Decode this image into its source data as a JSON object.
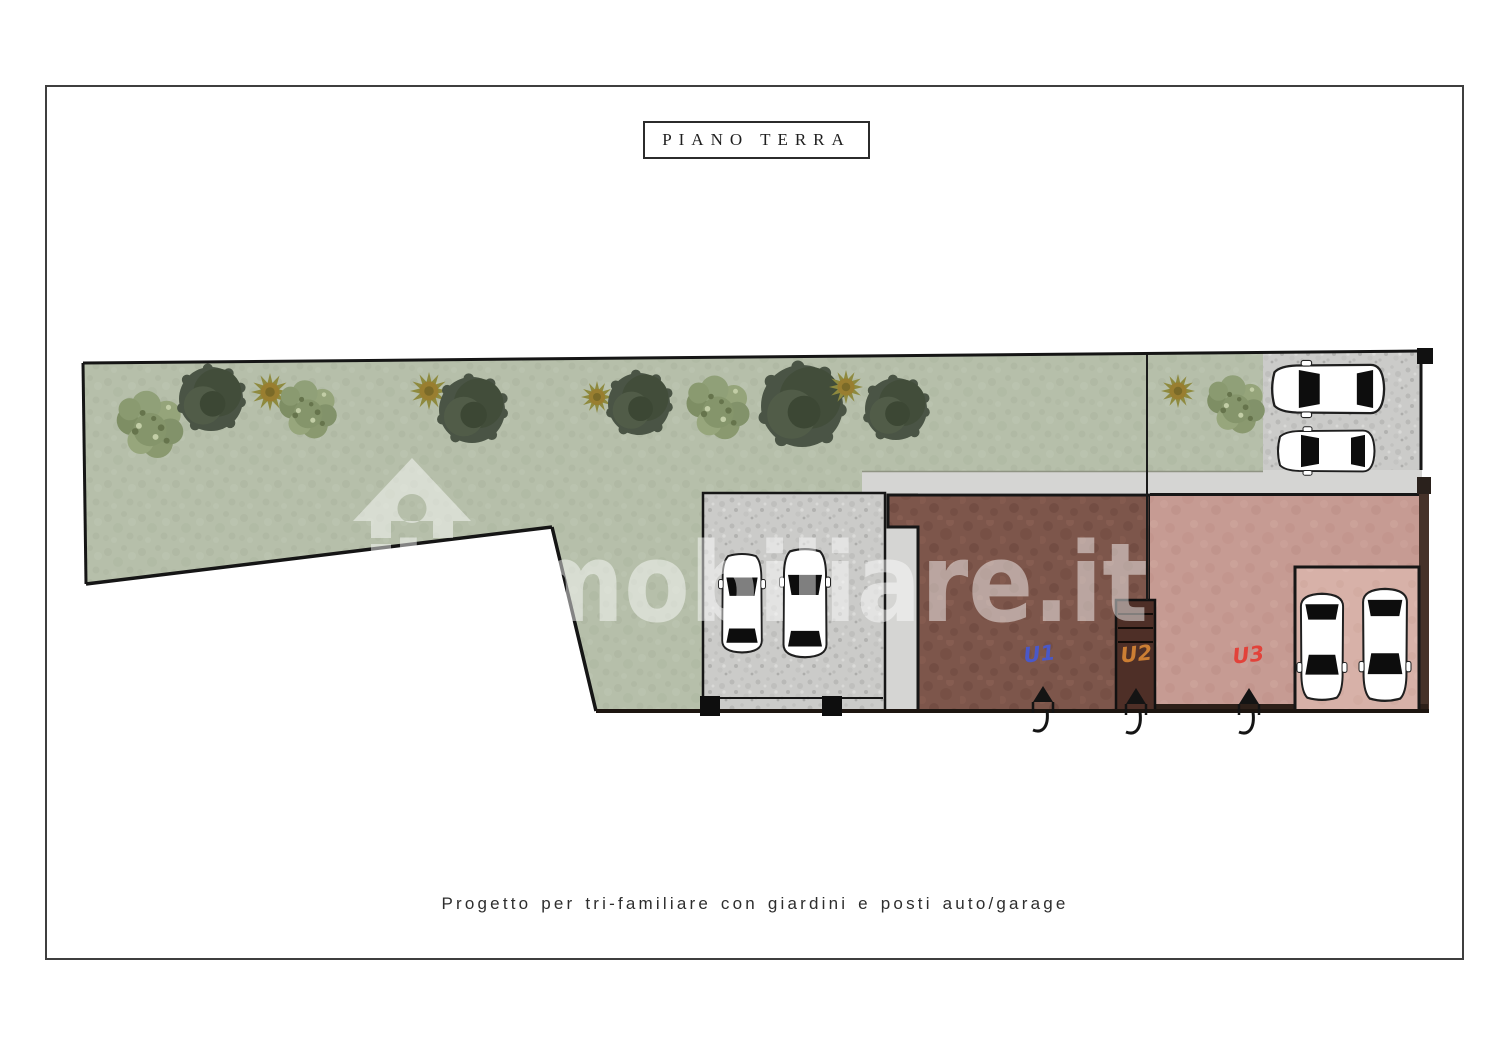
{
  "page": {
    "title": "PIANO TERRA",
    "caption": "Progetto per tri-familiare con giardini e posti auto/garage"
  },
  "watermark": {
    "text": "immobiliare.it",
    "icon": "house-arrow-icon"
  },
  "plan": {
    "units": [
      {
        "id": "u1",
        "label": "U1",
        "color": "#4a58c8"
      },
      {
        "id": "u2",
        "label": "U2",
        "color": "#cc7e33"
      },
      {
        "id": "u3",
        "label": "U3",
        "color": "#e2423a"
      }
    ],
    "counts": {
      "cars": 6,
      "trees_round": 5,
      "trees_shrub": 4,
      "trees_starburst": 5,
      "door_swings": 3
    },
    "icons": {
      "car": "car-top-view-icon",
      "round_tree": "round-tree-icon",
      "shrub": "shrub-icon",
      "starburst_tree": "starburst-tree-icon",
      "door": "door-swing-icon",
      "watermark_house": "house-arrow-icon"
    },
    "colors": {
      "garden": "#b6bfaa",
      "parking_gray": "#cbcbc9",
      "walkway_gray": "#d5d5d3",
      "building_brown": "#7d564b",
      "stairs_dark": "#4e2f27",
      "unit3_pink": "#c69b93",
      "garage_pink": "#d7b1a8",
      "outline": "#161616"
    }
  }
}
